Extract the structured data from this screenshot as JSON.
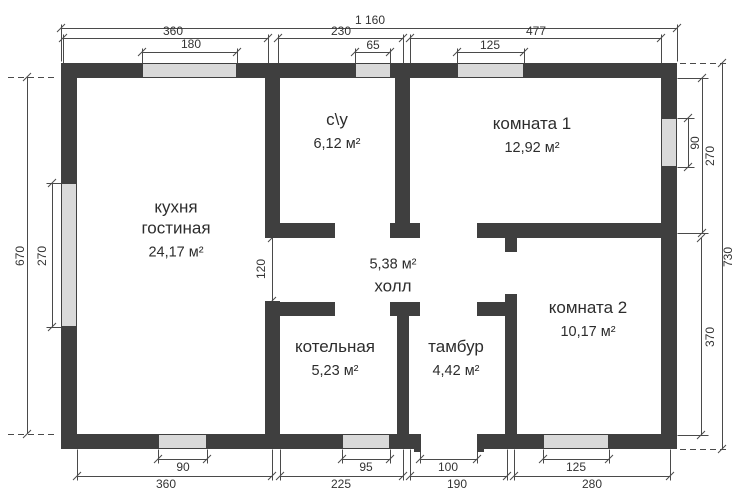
{
  "rooms": {
    "kitchen": {
      "name_line1": "кухня",
      "name_line2": "гостиная",
      "area": "24,17 м²"
    },
    "bathroom": {
      "name": "с\\у",
      "area": "6,12 м²"
    },
    "room1": {
      "name": "комната 1",
      "area": "12,92 м²"
    },
    "hall": {
      "area": "5,38 м²",
      "name": "холл"
    },
    "boiler": {
      "name": "котельная",
      "area": "5,23 м²"
    },
    "tambour": {
      "name": "тамбур",
      "area": "4,42 м²"
    },
    "room2": {
      "name": "комната 2",
      "area": "10,17 м²"
    }
  },
  "dimensions": {
    "top_total": "1 160",
    "top_sections": [
      "360",
      "230",
      "477"
    ],
    "top_openings": [
      "180",
      "65",
      "125"
    ],
    "bottom_openings": [
      "90",
      "95",
      "100",
      "125"
    ],
    "bottom_sections": [
      "360",
      "225",
      "190",
      "280"
    ],
    "left_height": "670",
    "left_window": "270",
    "hall_passage": "120",
    "right_window": "90",
    "right_room1_height": "270",
    "right_total": "730",
    "right_room2_height": "370"
  },
  "colors": {
    "wall": "#3f3f3f",
    "window_fill": "#d9d9d9",
    "dimension_line": "#4a4a4a",
    "background": "#ffffff"
  }
}
